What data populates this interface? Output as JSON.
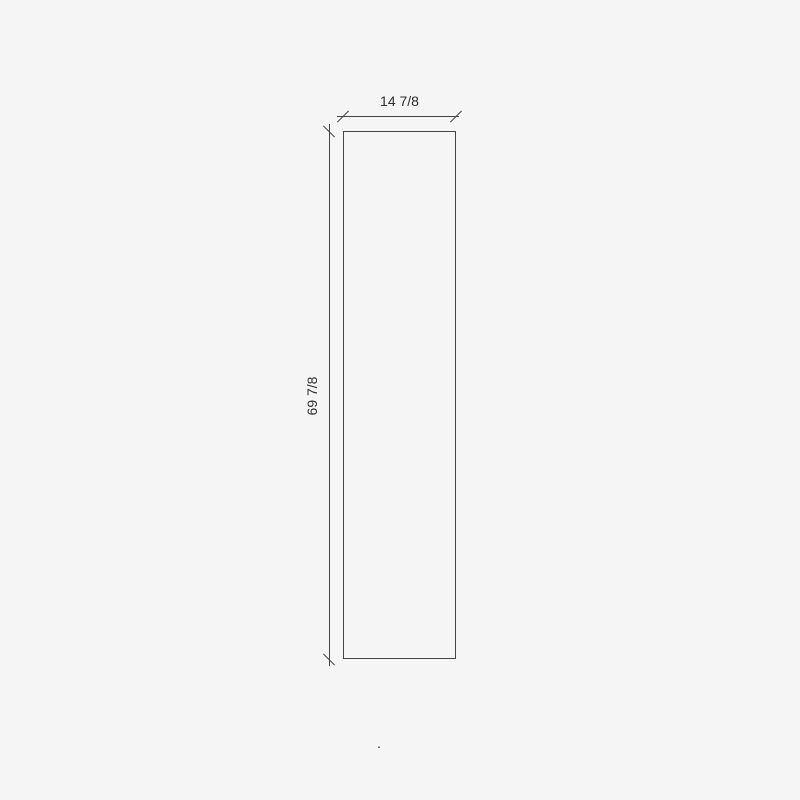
{
  "colors": {
    "background": "#f5f5f5",
    "line": "#454545",
    "text": "#2f2f2f"
  },
  "drawing": {
    "shape": "rectangle-panel-elevation",
    "width_dimension": {
      "label": "14 7/8"
    },
    "height_dimension": {
      "label": "69 7/8"
    }
  },
  "stray_mark": "."
}
